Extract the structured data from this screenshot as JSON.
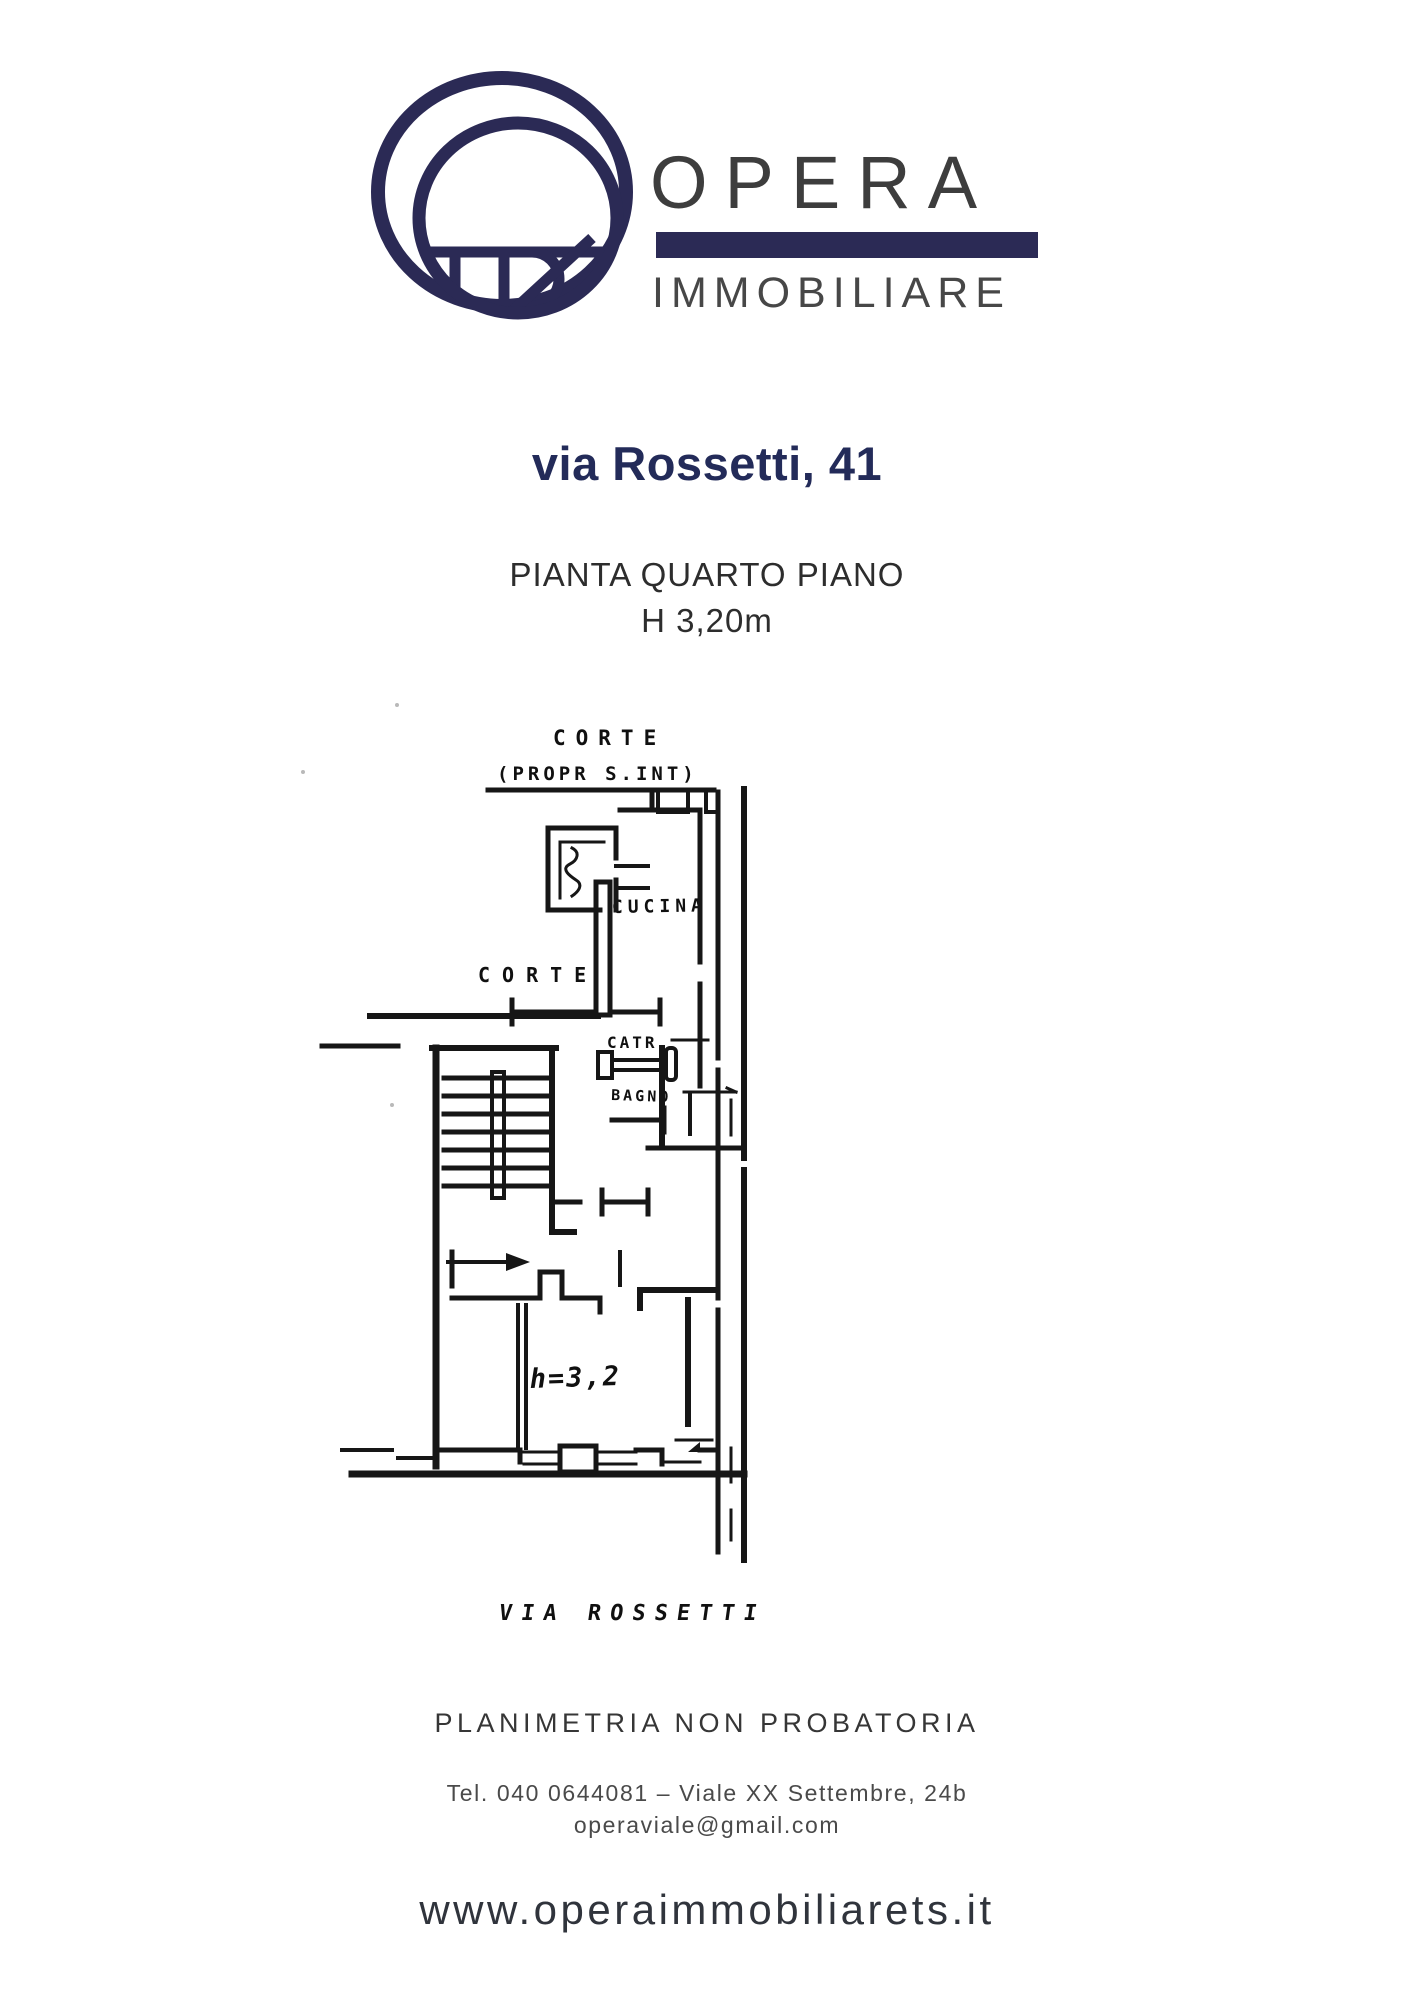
{
  "brand": {
    "name": "OPERA",
    "subtitle": "IMMOBILIARE",
    "navy": "#2b2a55",
    "text_gray": "#3d3d3d"
  },
  "listing": {
    "title": "via Rossetti, 41",
    "caption_line1": "PIANTA QUARTO PIANO",
    "caption_line2": "H 3,20m"
  },
  "floorplan": {
    "labels": {
      "courtyard_top_line1": "CORTE",
      "courtyard_top_line2": "(PROPR S.INT)",
      "kitchen": "CUCINA",
      "toilet": "CATR",
      "bath": "BAGNO",
      "courtyard_left": "CORTE",
      "height_note": "h=3,2",
      "street": "VIA ROSSETTI"
    }
  },
  "footer": {
    "disclaimer": "PLANIMETRIA NON PROBATORIA",
    "contact_line": "Tel. 040 0644081 – Viale XX Settembre, 24b",
    "email": "operaviale@gmail.com",
    "website": "www.operaimmobiliarets.it"
  }
}
